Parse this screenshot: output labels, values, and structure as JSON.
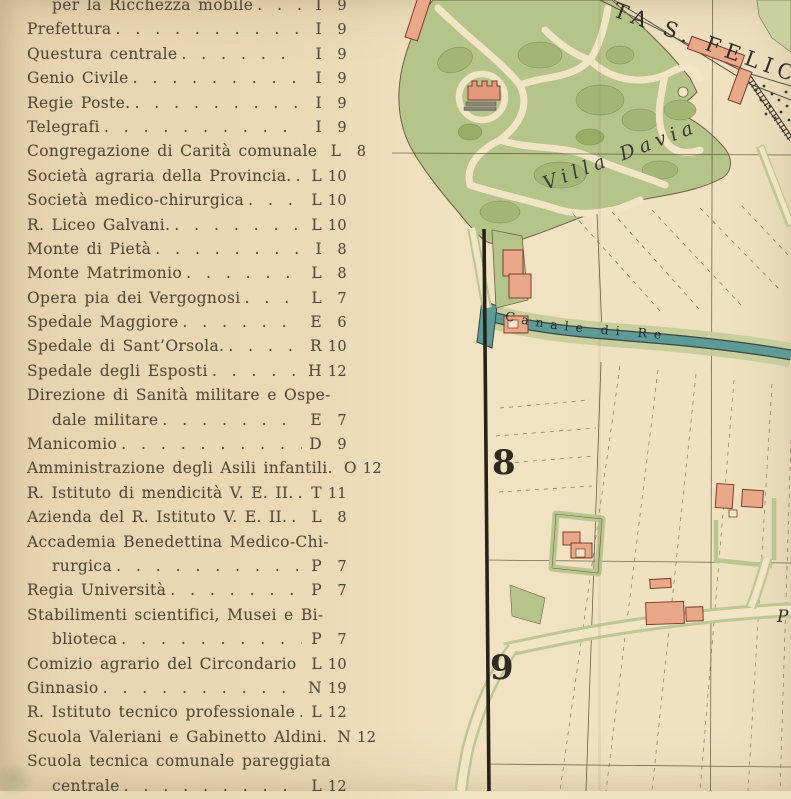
{
  "index": {
    "entries": [
      {
        "text": "per la Ricchezza mobile",
        "letter": "I",
        "num": "9",
        "indent": true,
        "leader": true
      },
      {
        "text": "Prefettura",
        "letter": "I",
        "num": "9",
        "indent": false,
        "leader": true
      },
      {
        "text": "Questura centrale",
        "letter": "I",
        "num": "9",
        "indent": false,
        "leader": true
      },
      {
        "text": "Genio Civile",
        "letter": "I",
        "num": "9",
        "indent": false,
        "leader": true
      },
      {
        "text": "Regie Poste.",
        "letter": "I",
        "num": "9",
        "indent": false,
        "leader": true
      },
      {
        "text": "Telegrafi",
        "letter": "I",
        "num": "9",
        "indent": false,
        "leader": true
      },
      {
        "text": "Congregazione di Carità comunale",
        "letter": "L",
        "num": "8",
        "indent": false,
        "leader": true
      },
      {
        "text": "Società agraria della Provincia.",
        "letter": "L",
        "num": "10",
        "indent": false,
        "leader": true
      },
      {
        "text": "Società medico-chirurgica",
        "letter": "L",
        "num": "10",
        "indent": false,
        "leader": true
      },
      {
        "text": "R. Liceo Galvani.",
        "letter": "L",
        "num": "10",
        "indent": false,
        "leader": true
      },
      {
        "text": "Monte di Pietà",
        "letter": "I",
        "num": "8",
        "indent": false,
        "leader": true
      },
      {
        "text": "Monte Matrimonio",
        "letter": "L",
        "num": "8",
        "indent": false,
        "leader": true
      },
      {
        "text": "Opera pia dei Vergognosi",
        "letter": "L",
        "num": "7",
        "indent": false,
        "leader": true
      },
      {
        "text": "Spedale Maggiore",
        "letter": "E",
        "num": "6",
        "indent": false,
        "leader": true
      },
      {
        "text": "Spedale di Sant’Orsola.",
        "letter": "R",
        "num": "10",
        "indent": false,
        "leader": true
      },
      {
        "text": "Spedale degli Esposti",
        "letter": "H",
        "num": "12",
        "indent": false,
        "leader": true
      },
      {
        "text": "Direzione di Sanità militare e Ospe-",
        "letter": "",
        "num": "",
        "indent": false,
        "leader": false
      },
      {
        "text": "dale militare",
        "letter": "E",
        "num": "7",
        "indent": true,
        "leader": true
      },
      {
        "text": "Manicomio",
        "letter": "D",
        "num": "9",
        "indent": false,
        "leader": true
      },
      {
        "text": "Amministrazione degli Asili infantili.",
        "letter": "O",
        "num": "12",
        "indent": false,
        "leader": true
      },
      {
        "text": "R. Istituto di mendicità V. E. II.",
        "letter": "T",
        "num": "11",
        "indent": false,
        "leader": true
      },
      {
        "text": "Azienda del R. Istituto V. E. II.",
        "letter": "L",
        "num": "8",
        "indent": false,
        "leader": true
      },
      {
        "text": "Accademia Benedettina Medico-Chi-",
        "letter": "",
        "num": "",
        "indent": false,
        "leader": false
      },
      {
        "text": "rurgica",
        "letter": "P",
        "num": "7",
        "indent": true,
        "leader": true
      },
      {
        "text": "Regia Università",
        "letter": "P",
        "num": "7",
        "indent": false,
        "leader": true
      },
      {
        "text": "Stabilimenti scientifici, Musei e Bi-",
        "letter": "",
        "num": "",
        "indent": false,
        "leader": false
      },
      {
        "text": "blioteca",
        "letter": "P",
        "num": "7",
        "indent": true,
        "leader": true
      },
      {
        "text": "Comizio agrario del Circondario",
        "letter": "L",
        "num": "10",
        "indent": false,
        "leader": true
      },
      {
        "text": "Ginnasio",
        "letter": "N",
        "num": "19",
        "indent": false,
        "leader": true
      },
      {
        "text": "R. Istituto tecnico professionale",
        "letter": "L",
        "num": "12",
        "indent": false,
        "leader": true
      },
      {
        "text": "Scuola Valeriani e Gabinetto Aldini.",
        "letter": "N",
        "num": "12",
        "indent": false,
        "leader": true
      },
      {
        "text": "Scuola tecnica comunale pareggiata",
        "letter": "",
        "num": "",
        "indent": false,
        "leader": false
      },
      {
        "text": "centrale",
        "letter": "L",
        "num": "12",
        "indent": true,
        "leader": true
      }
    ]
  },
  "map": {
    "street_label": "TA S. FELICE",
    "villa_label": "Villa Davia",
    "canal_label": "Canale di Re",
    "partial_label": "P",
    "grid_row_8": "8",
    "grid_row_9": "9"
  },
  "colors": {
    "paper": "#ecdab7",
    "map_paper": "#f2e5c5",
    "park_green": "#b5c489",
    "park_dark_green": "#a4b676",
    "canal_teal": "#5f9b96",
    "bank_green": "#c5ce9b",
    "building_salmon": "#e9a888",
    "building_outline": "#7e3b2f",
    "ink": "#4a4438",
    "text_brown": "#554a39"
  }
}
